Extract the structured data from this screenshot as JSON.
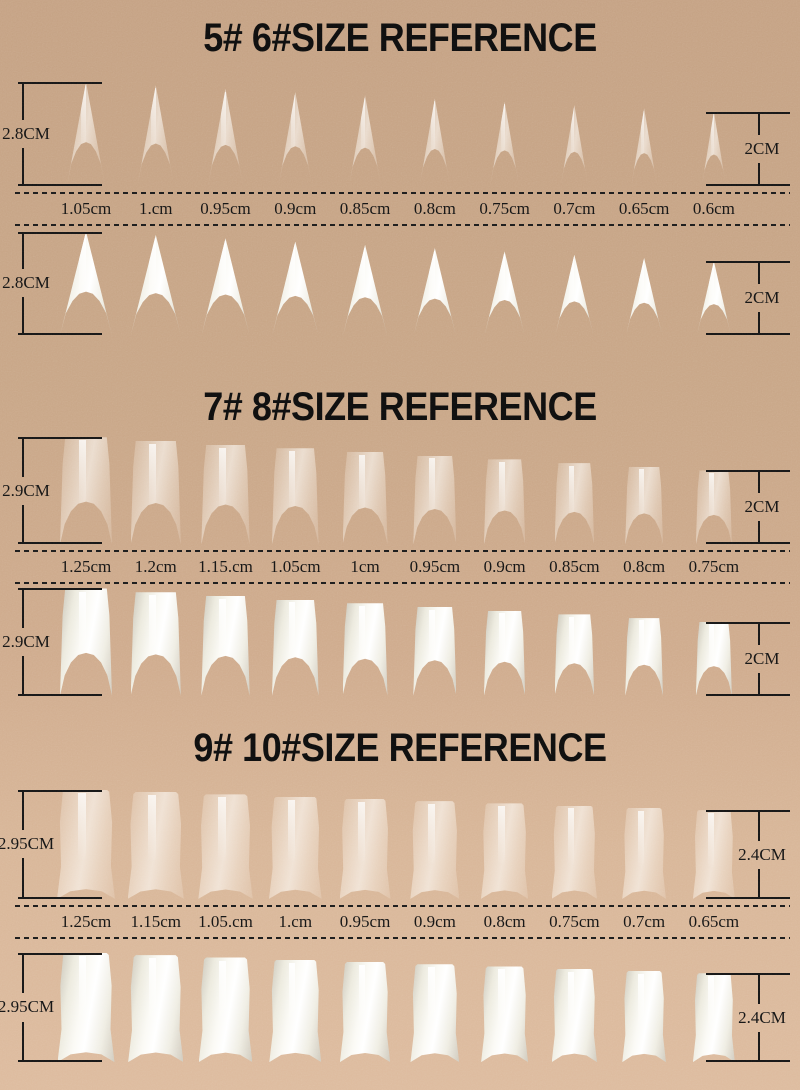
{
  "colors": {
    "paper": "#c9a687",
    "paper_light": "#ddbb9e",
    "ink": "#141414",
    "nail_white": "#f7f5ef"
  },
  "sections": [
    {
      "title": "5# 6#SIZE REFERENCE",
      "shape": "stiletto",
      "left_measure": {
        "label": "2.8CM",
        "cm": 2.8
      },
      "right_measure": {
        "label": "2CM",
        "cm": 2.0
      },
      "size_labels": [
        "1.05cm",
        "1.cm",
        "0.95cm",
        "0.9cm",
        "0.85cm",
        "0.8cm",
        "0.75cm",
        "0.7cm",
        "0.65cm",
        "0.6cm"
      ],
      "rows": [
        {
          "variant": "clear"
        },
        {
          "variant": "white"
        }
      ]
    },
    {
      "title": "7# 8#SIZE REFERENCE",
      "shape": "curved",
      "left_measure": {
        "label": "2.9CM",
        "cm": 2.9
      },
      "right_measure": {
        "label": "2CM",
        "cm": 2.0
      },
      "size_labels": [
        "1.25cm",
        "1.2cm",
        "1.15.cm",
        "1.05cm",
        "1cm",
        "0.95cm",
        "0.9cm",
        "0.85cm",
        "0.8cm",
        "0.75cm"
      ],
      "rows": [
        {
          "variant": "clear"
        },
        {
          "variant": "white"
        }
      ]
    },
    {
      "title": "9# 10#SIZE REFERENCE",
      "shape": "square",
      "left_measure": {
        "label": "2.95CM",
        "cm": 2.95
      },
      "right_measure": {
        "label": "2.4CM",
        "cm": 2.4
      },
      "size_labels": [
        "1.25cm",
        "1.15cm",
        "1.05.cm",
        "1.cm",
        "0.95cm",
        "0.9cm",
        "0.8cm",
        "0.75cm",
        "0.7cm",
        "0.65cm"
      ],
      "rows": [
        {
          "variant": "clear"
        },
        {
          "variant": "white"
        }
      ]
    }
  ]
}
